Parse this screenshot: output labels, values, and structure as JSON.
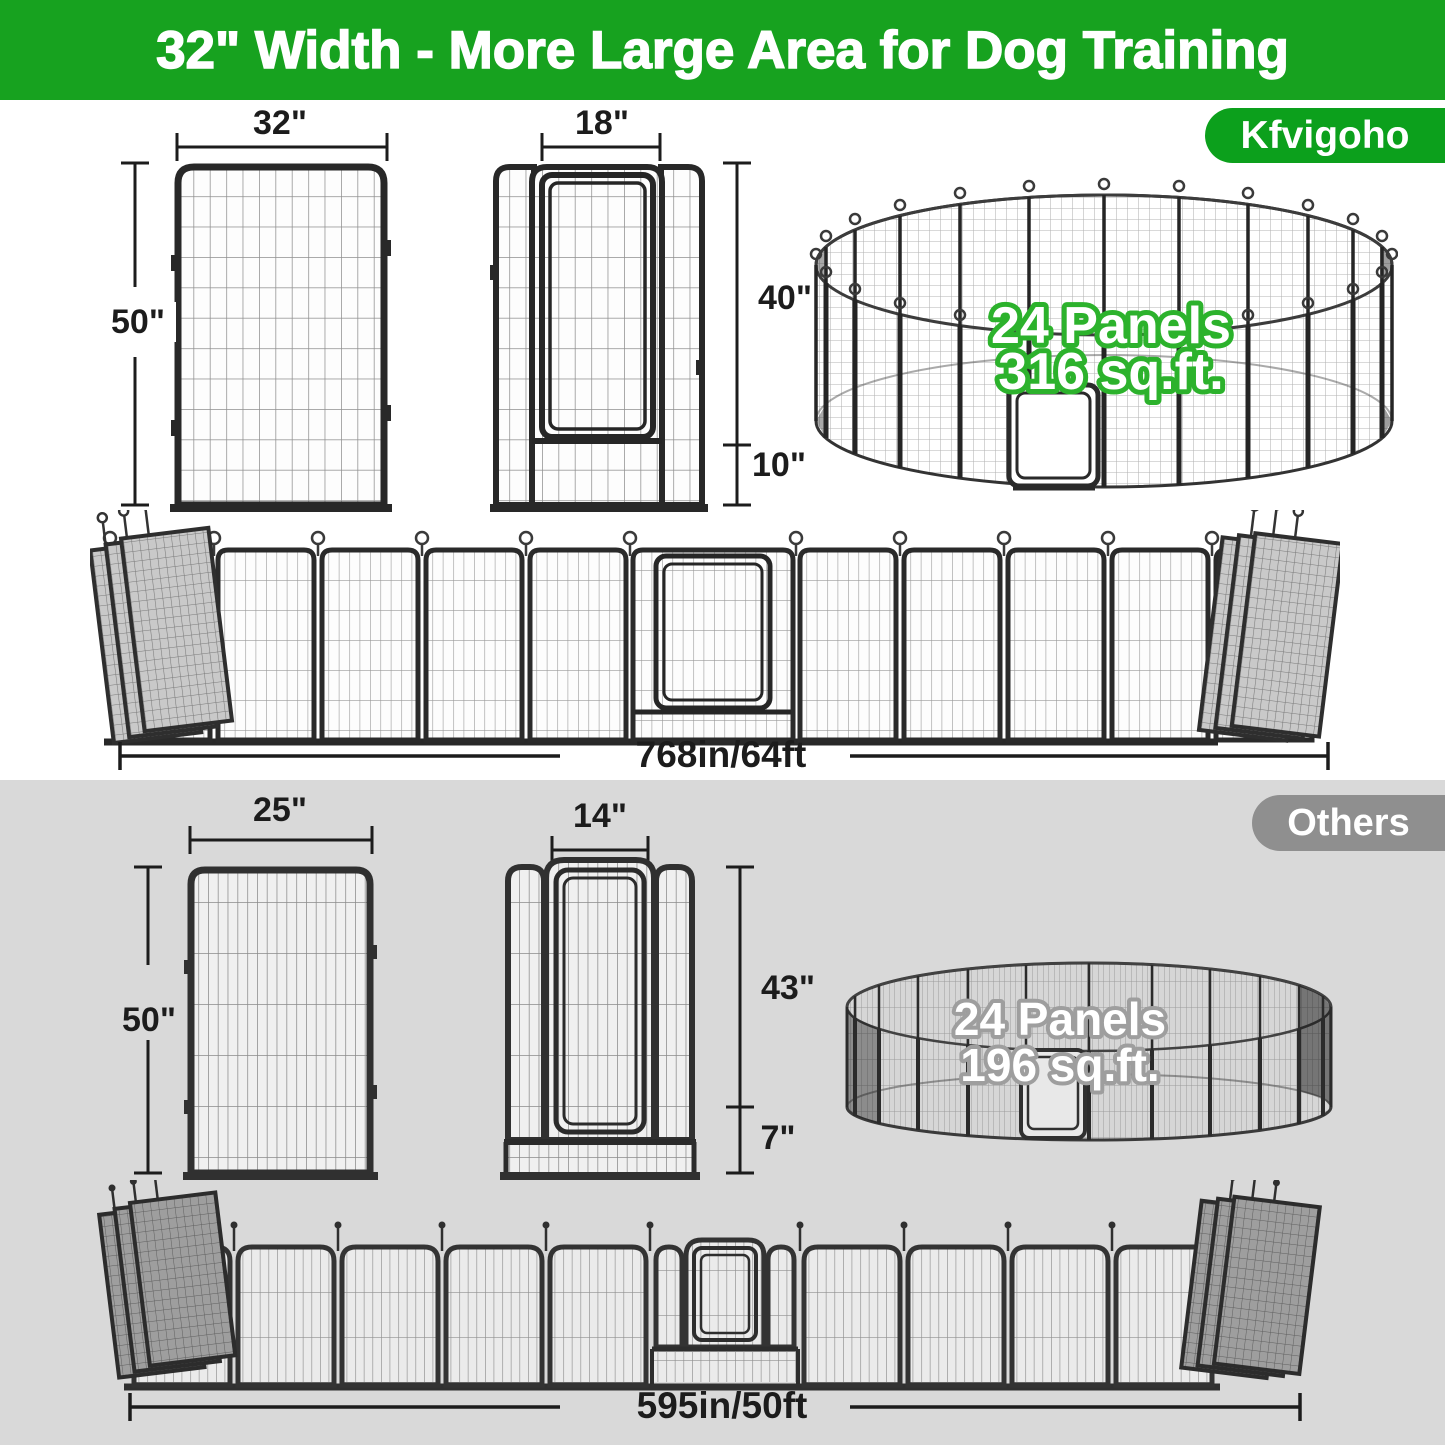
{
  "banner": {
    "title": "32\" Width - More Large Area for Dog Training"
  },
  "brand_badge": "Kfvigoho",
  "others_badge": "Others",
  "kfvigoho_section": {
    "single_panel": {
      "width": "32\"",
      "height": "50\""
    },
    "door_panel": {
      "door_width": "18\"",
      "door_height": "40\"",
      "bottom_height": "10\""
    },
    "circular_pen": {
      "panel_count": "24 Panels",
      "area": "316 sq.ft."
    },
    "layout_row": {
      "total_length": "768in/64ft"
    }
  },
  "others_section": {
    "single_panel": {
      "width": "25\"",
      "height": "50\""
    },
    "door_panel": {
      "door_width": "14\"",
      "door_height": "43\"",
      "bottom_height": "7\""
    },
    "circular_pen": {
      "panel_count": "24 Panels",
      "area": "196 sq.ft."
    },
    "layout_row": {
      "total_length": "595in/50ft"
    }
  },
  "colors": {
    "banner_green": "#17A21F",
    "badge_green": "#0CA01C",
    "highlight_green": "#2CB22C",
    "others_bg_gray": "#D9D9D9",
    "others_badge_gray": "#8F8F8F",
    "ink": "#1C1C1C"
  }
}
